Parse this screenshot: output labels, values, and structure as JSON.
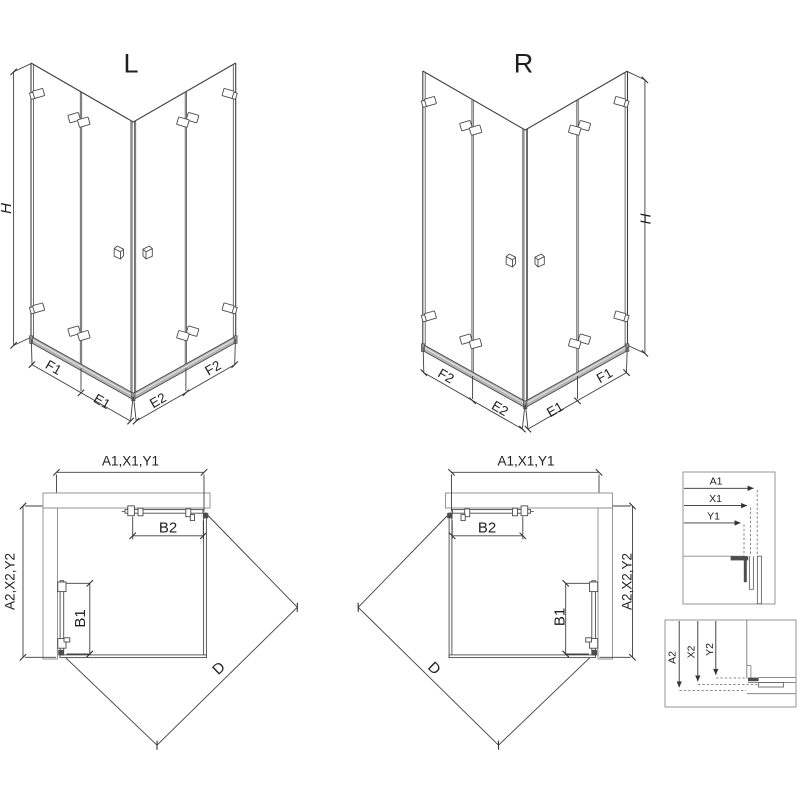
{
  "iso_views": {
    "left": {
      "title": "L",
      "height_dim": "H",
      "base_dims": [
        "F1",
        "E1",
        "E2",
        "F2"
      ]
    },
    "right": {
      "title": "R",
      "height_dim": "H",
      "base_dims": [
        "F2",
        "E2",
        "E1",
        "F1"
      ]
    }
  },
  "plan_views": {
    "left": {
      "width_dim": "A1,X1,Y1",
      "depth_dim": "A2,X2,Y2",
      "top_door_dim": "B2",
      "side_door_dim": "B1",
      "diagonal_dim": "D"
    },
    "right": {
      "width_dim": "A1,X1,Y1",
      "depth_dim": "A2,X2,Y2",
      "top_door_dim": "B2",
      "side_door_dim": "B1",
      "diagonal_dim": "D"
    }
  },
  "detail_panels": {
    "horizontal_dims": [
      "A1",
      "X1",
      "Y1"
    ],
    "vertical_dims": [
      "A2",
      "X2",
      "Y2"
    ]
  },
  "colors": {
    "line": "#3f3f3f",
    "construction": "#8a8a8a",
    "dark_profile": "#4d4d4d",
    "rail_fill": "#b5b5b5",
    "text": "#1f1f1f",
    "background": "#ffffff"
  }
}
